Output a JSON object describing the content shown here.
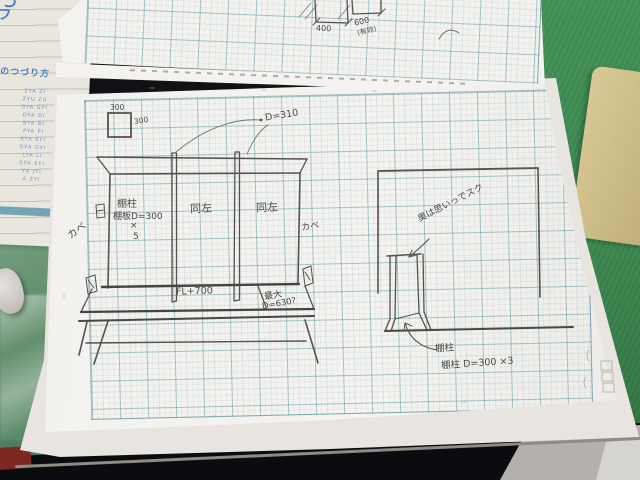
{
  "colors": {
    "desk_mat_green": "#3f8a52",
    "desk_black": "#0b0d11",
    "page_white": "#f3f1ee",
    "grid_teal": "#7fb3b8",
    "pencil_grey": "#55524d",
    "reference_sheet_blue": "#4f7dc0",
    "yellow_paper": "#cdbe8c",
    "red_scrap": "#7b2822"
  },
  "upper_page": {
    "dim_400": "400",
    "dim_600": "600",
    "dim_600_note": "(有効)"
  },
  "main_page": {
    "scale_square": {
      "top_label": "300",
      "side_label": "300"
    },
    "front_view": {
      "depth_note": "D=310",
      "post_label": "棚柱",
      "shelf_board_label": "棚板D=300",
      "multiplier_sign": "×",
      "multiplier_count": "5",
      "same_as_left_bay2": "同左",
      "same_as_left_bay3": "同左",
      "wall_label_left": "カベ",
      "wall_label_right": "カベ",
      "counter_height_label": "FL+700",
      "max_label": "最大",
      "max_depth_label": "D=630?"
    },
    "side_view": {
      "note": "奥は思いっでスク",
      "post_label": "棚柱",
      "post_spec_label": "棚柱 D=300 ×3"
    }
  },
  "reference_sheet": {
    "title": "のつづり方",
    "corner_glyph_1": "つ",
    "corner_glyph_2": "フ",
    "rows": [
      "ZYA ZI",
      "ZYU ZU",
      "GYA GYI",
      "DYA DI",
      "BYA BI",
      "PYA PI",
      "KYA KYI",
      "GYA GYI",
      "LYA LI",
      "SYA SYI",
      "YA JYI",
      "A ZYI"
    ]
  }
}
